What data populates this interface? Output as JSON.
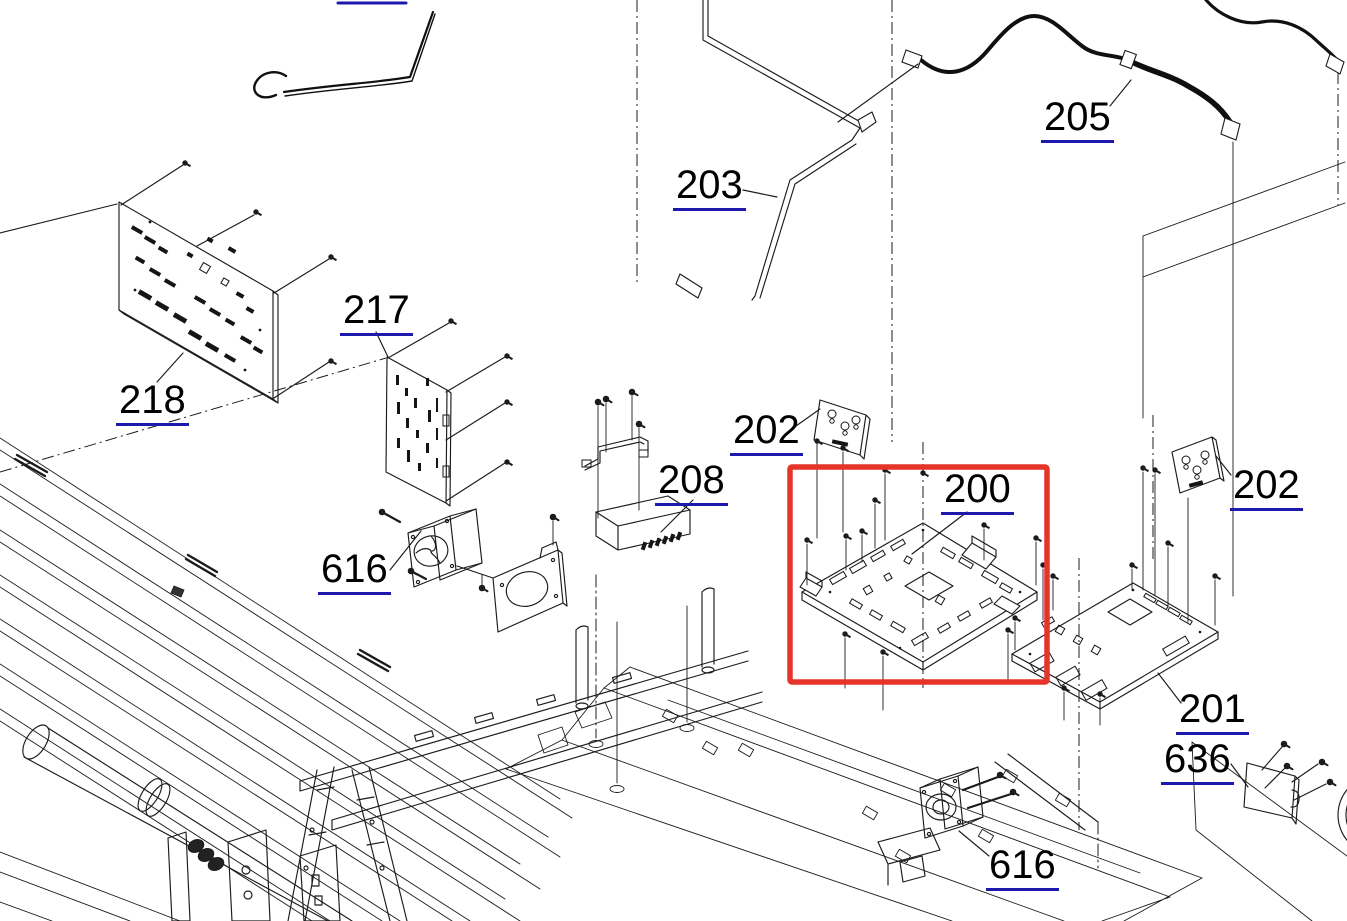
{
  "diagram": {
    "type": "exploded-parts-diagram",
    "background_color": "#ffffff",
    "line_color": "#1b1b1b",
    "label_text_color": "#000000",
    "label_underline_color": "#1d19ac",
    "highlight_box_color": "#e5352b",
    "highlighted_part": "200",
    "callouts": {
      "c218": "218",
      "c217": "217",
      "c203": "203",
      "c205": "205",
      "c202a": "202",
      "c208": "208",
      "c616a": "616",
      "c200": "200",
      "c202b": "202",
      "c201": "201",
      "c636": "636",
      "c616b": "616"
    }
  }
}
